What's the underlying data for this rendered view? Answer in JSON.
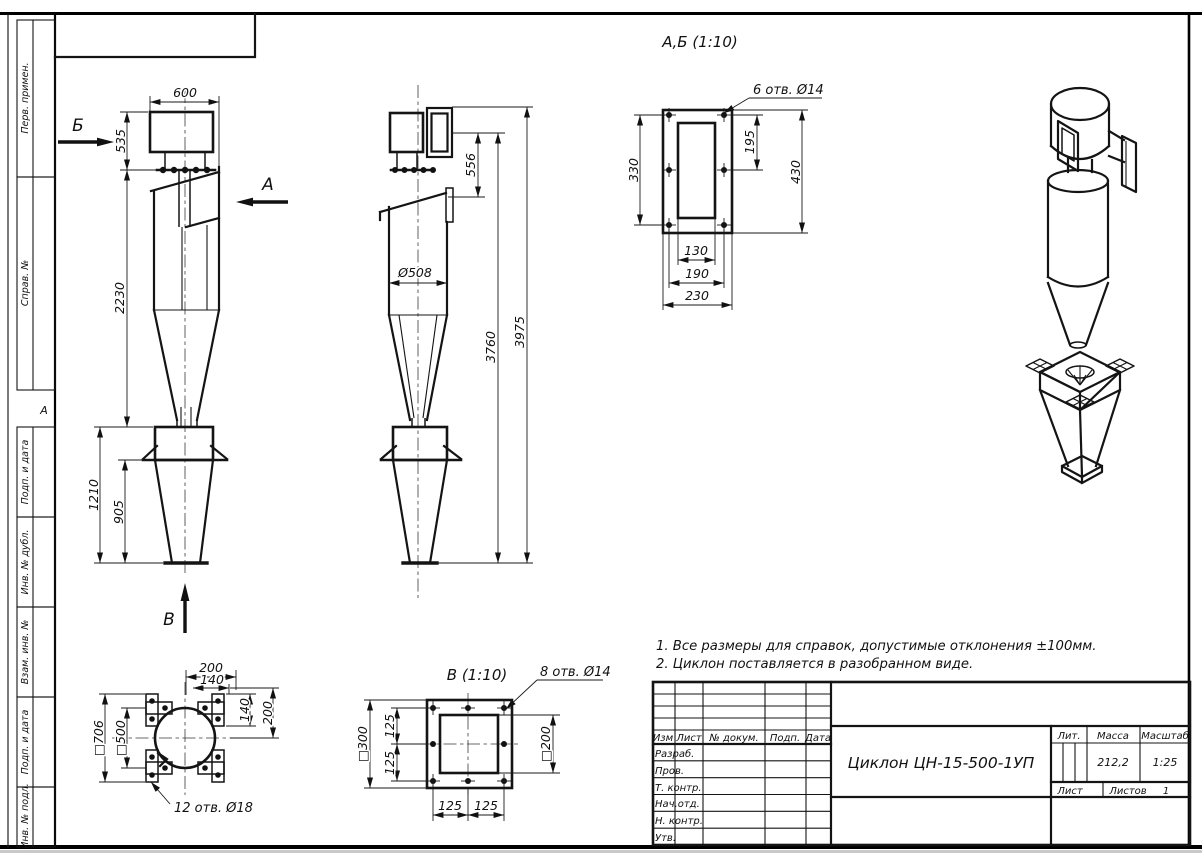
{
  "sheet": {
    "zone_marker": "А"
  },
  "sidebar": {
    "labels": [
      "Перв. примен.",
      "Справ. №",
      "Подп. и дата",
      "Инв. № дубл.",
      "Взам. инв. №",
      "Подп. и дата",
      "Инв. № подл."
    ]
  },
  "side_view": {
    "label_b": "Б",
    "label_a": "А",
    "label_v": "В",
    "d600": "600",
    "d535": "535",
    "d2230": "2230",
    "d1210": "1210",
    "d905": "905"
  },
  "front_view": {
    "d508": "Ø508",
    "d556": "556",
    "d3760": "3760",
    "d3975": "3975"
  },
  "detail_ab": {
    "title": "А,Б (1:10)",
    "callout": "6 отв. Ø14",
    "d330": "330",
    "d195": "195",
    "d430": "430",
    "d130": "130",
    "d190": "190",
    "d230": "230"
  },
  "detail_v": {
    "title": "В (1:10)",
    "callout": "8 отв. Ø14",
    "d300": "□300",
    "d125a": "125",
    "d125b": "125",
    "d200": "□200",
    "d125c": "125",
    "d125d": "125"
  },
  "plan_view": {
    "callout": "12 отв. Ø18",
    "d200t": "200",
    "d140t": "140",
    "d140r": "140",
    "d200r": "200",
    "d706": "□706",
    "d500": "□500"
  },
  "notes": {
    "n1": "1. Все размеры для справок, допустимые отклонения ±100мм.",
    "n2": "2. Циклон поставляется в разобранном виде."
  },
  "title_block": {
    "doc_title": "Циклон ЦН-15-500-1УП",
    "header_cols": [
      "Изм",
      "Лист",
      "№ докум.",
      "Подп.",
      "Дата"
    ],
    "sig_rows": [
      "Разраб.",
      "Пров.",
      "Т. контр.",
      "Нач.отд.",
      "Н. контр.",
      "Утв."
    ],
    "lit_label": "Лит.",
    "mass_label": "Масса",
    "scale_label": "Масштаб",
    "mass_value": "212,2",
    "scale_value": "1:25",
    "sheet_label": "Лист",
    "sheets_label": "Листов",
    "sheets_value": "1"
  },
  "colors": {
    "ink": "#141414",
    "paper": "#ffffff"
  }
}
